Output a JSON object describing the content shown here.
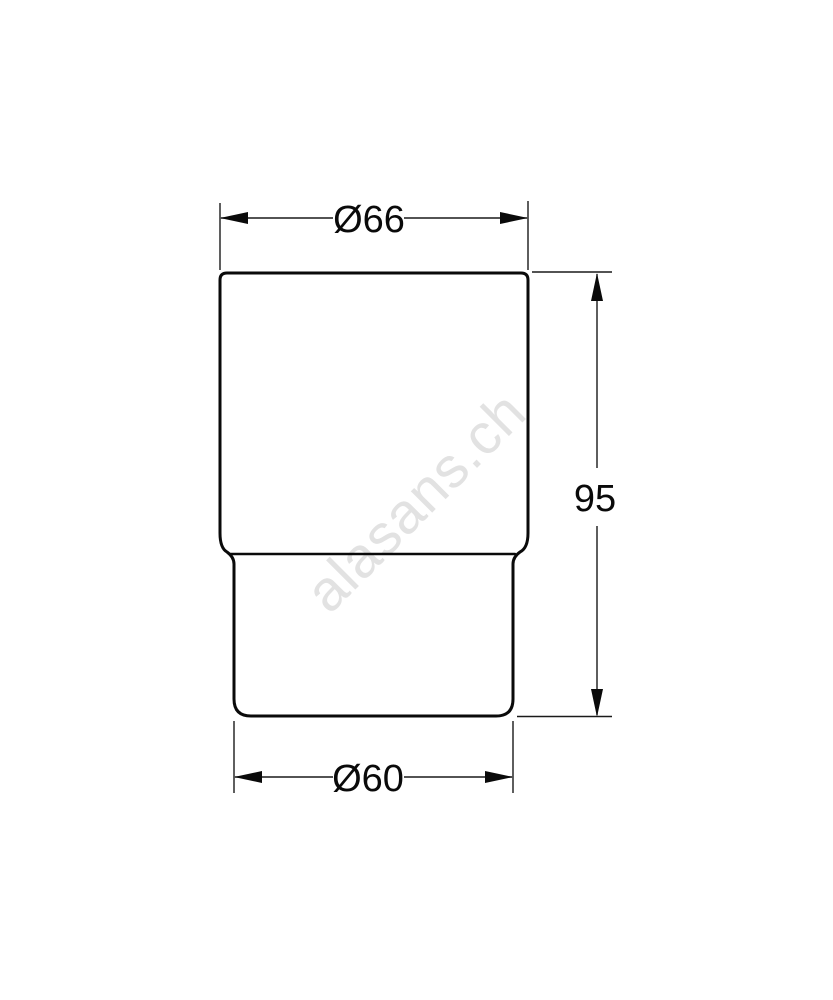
{
  "page": {
    "background_color": "#ffffff",
    "line_color": "#0a0a0a"
  },
  "watermark": {
    "text": "alasans.ch",
    "color": "#e2e2e2"
  },
  "drawing": {
    "kind": "technical-dimension-drawing",
    "subject": "glass-tumbler-side-profile",
    "dimensions": {
      "top_diameter": {
        "label": "Ø66",
        "value": 66
      },
      "bottom_diameter": {
        "label": "Ø60",
        "value": 60
      },
      "height": {
        "label": "95",
        "value": 95
      }
    }
  }
}
